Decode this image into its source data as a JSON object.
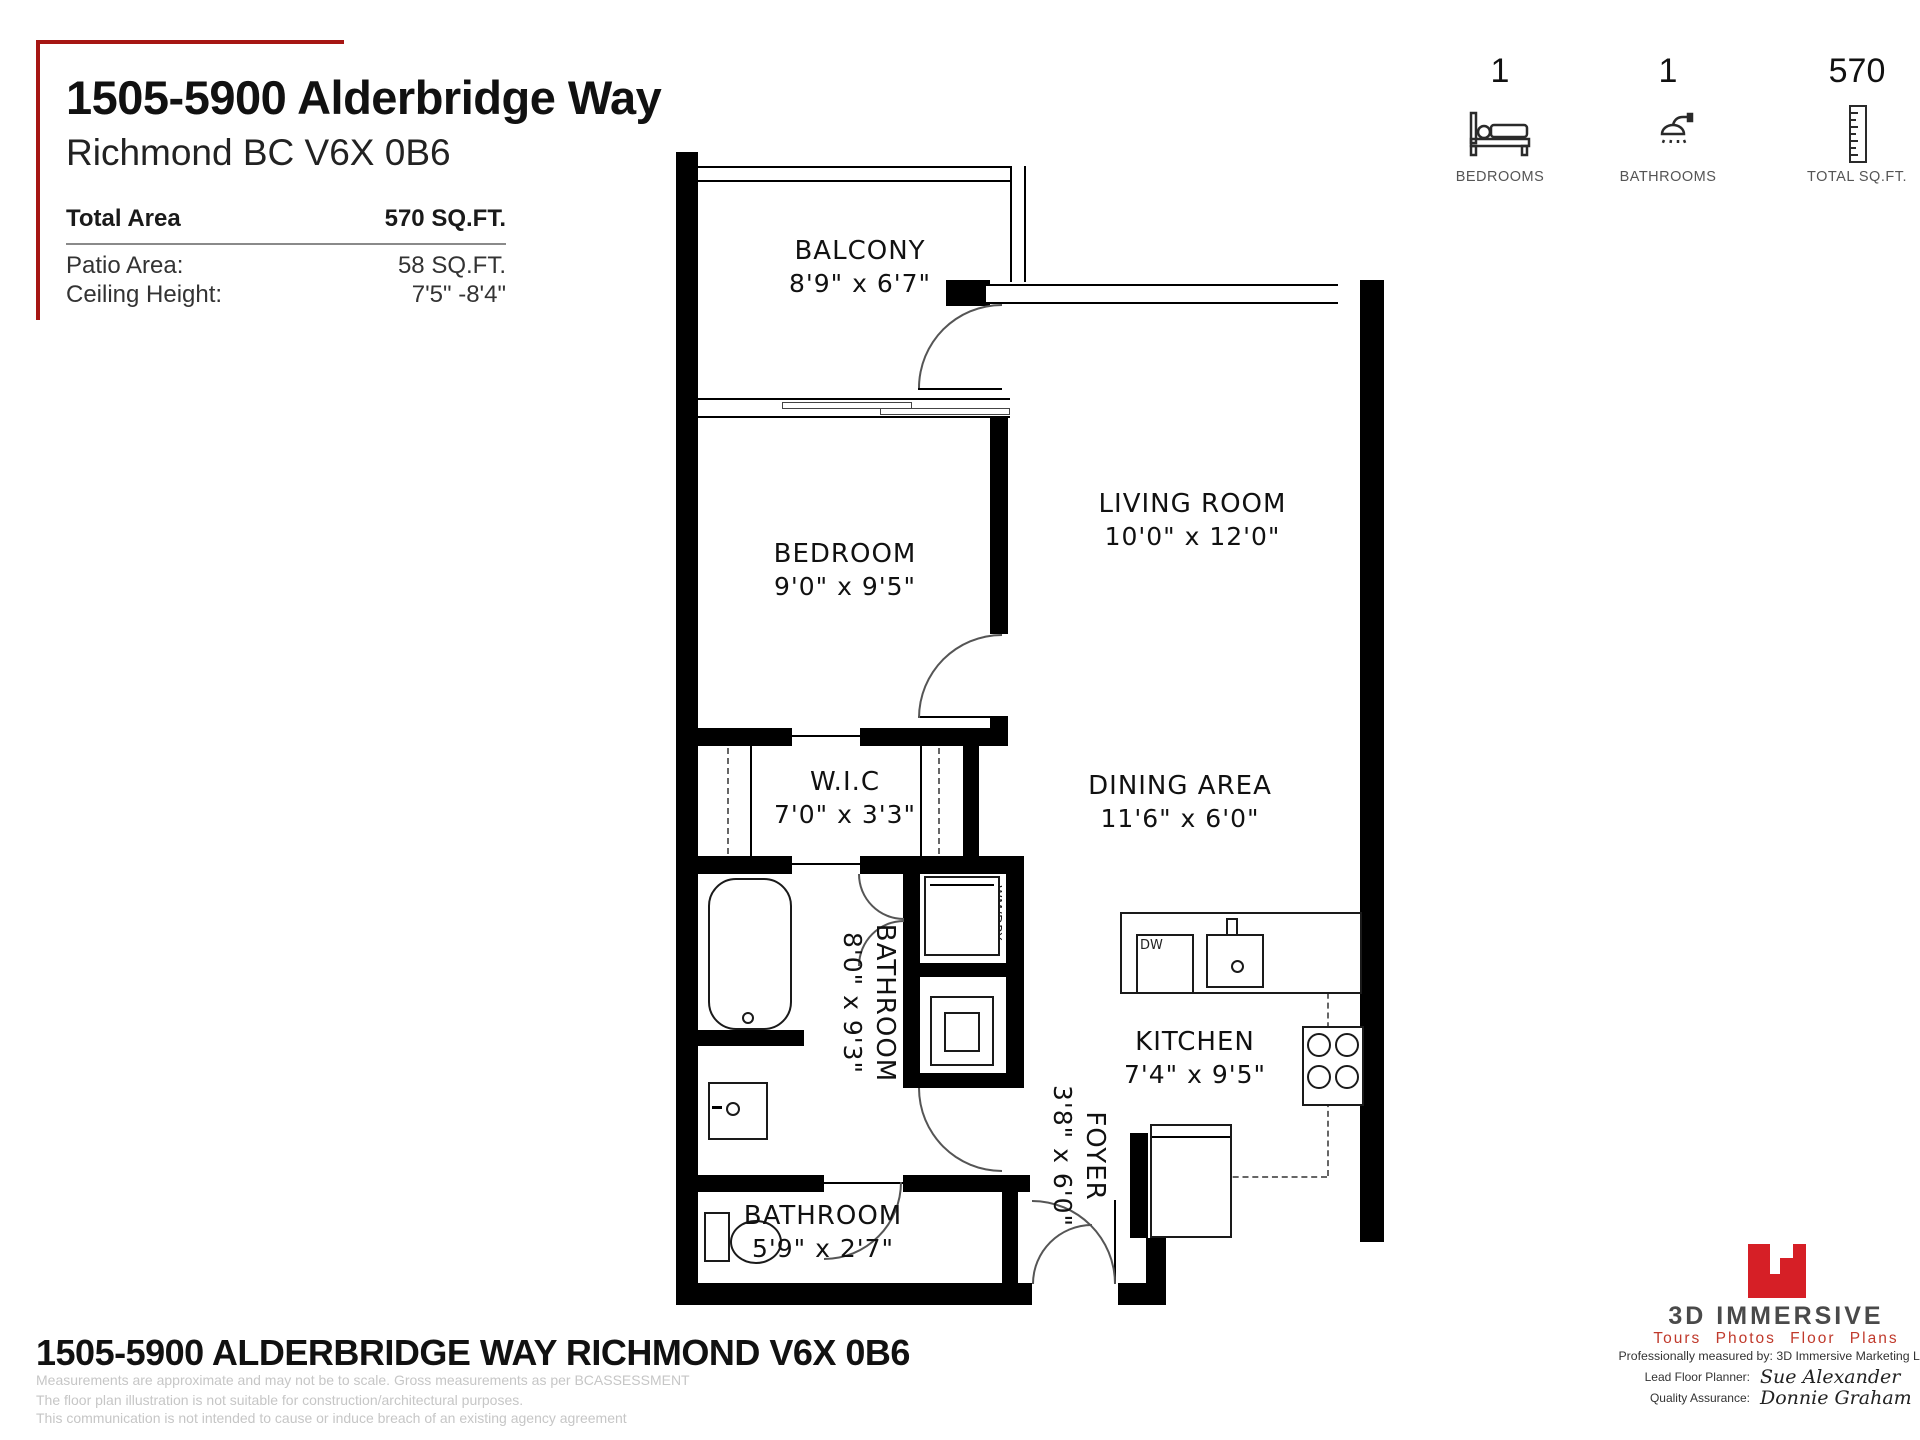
{
  "header": {
    "title": "1505-5900 Alderbridge Way",
    "subtitle": "Richmond BC V6X 0B6",
    "total_area_label": "Total Area",
    "total_area_value": "570 SQ.FT.",
    "patio_label": "Patio Area:",
    "patio_value": "58 SQ.FT.",
    "ceiling_label": "Ceiling Height:",
    "ceiling_value": "7'5\" -8'4\""
  },
  "stats": {
    "bedrooms": {
      "value": "1",
      "label": "BEDROOMS"
    },
    "bathrooms": {
      "value": "1",
      "label": "BATHROOMS"
    },
    "total_sqft": {
      "value": "570",
      "label": "TOTAL SQ.FT."
    }
  },
  "rooms": {
    "balcony": {
      "name": "BALCONY",
      "dims": "8'9\" x 6'7\""
    },
    "bedroom": {
      "name": "BEDROOM",
      "dims": "9'0\" x 9'5\""
    },
    "living": {
      "name": "LIVING ROOM",
      "dims": "10'0\" x 12'0\""
    },
    "wic": {
      "name": "W.I.C",
      "dims": "7'0\" x 3'3\""
    },
    "dining": {
      "name": "DINING AREA",
      "dims": "11'6\" x 6'0\""
    },
    "bathroom_main": {
      "name": "BATHROOM",
      "dims": "8'0\" x 9'3\""
    },
    "kitchen": {
      "name": "KITCHEN",
      "dims": "7'4\" x 9'5\""
    },
    "foyer": {
      "name": "FOYER",
      "dims": "3'8\" x 6'0\""
    },
    "bathroom_small": {
      "name": "BATHROOM",
      "dims": "5'9\" x 2'7\""
    }
  },
  "fixtures": {
    "washer_dryer": "WM/DRY",
    "dishwasher": "DW"
  },
  "footer": {
    "title": "1505-5900 ALDERBRIDGE WAY RICHMOND V6X 0B6",
    "disclaimer1": "Measurements are approximate and may not be to scale. Gross measurements as per BCASSESSMENT",
    "disclaimer2": "The floor plan illustration is not suitable for construction/architectural purposes.",
    "disclaimer3": "This communication is not intended to cause or induce breach of an existing agency agreement"
  },
  "branding": {
    "name": "3D IMMERSIVE",
    "tagline": "Tours  Photos  Floor Plans",
    "measured_by": "Professionally measured by: 3D Immersive Marketing Ltd.",
    "planner_label": "Lead Floor Planner:",
    "planner_name": "Sue Alexander",
    "qa_label": "Quality Assurance:",
    "qa_name": "Donnie Graham"
  },
  "colors": {
    "accent_red": "#a61613",
    "logo_red": "#d61f26",
    "wall_black": "#000000"
  }
}
